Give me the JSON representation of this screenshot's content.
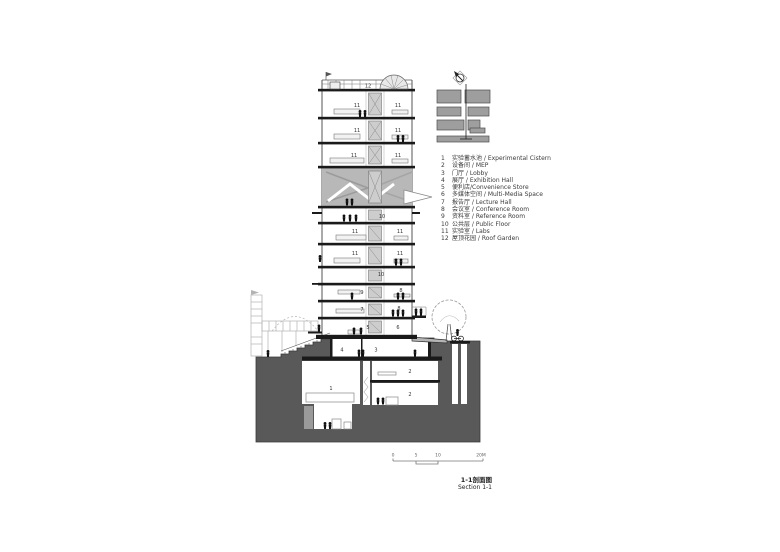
{
  "legend": {
    "items": [
      {
        "num": "1",
        "label": "实验蓄水池 / Experimental Cistern"
      },
      {
        "num": "2",
        "label": "设备间 / MEP"
      },
      {
        "num": "3",
        "label": "门厅 / Lobby"
      },
      {
        "num": "4",
        "label": "展厅 / Exhibition Hall"
      },
      {
        "num": "5",
        "label": "便利店/Convenience Store"
      },
      {
        "num": "6",
        "label": "多媒体空间 / Multi-Media Space"
      },
      {
        "num": "7",
        "label": "报告厅 / Lecture Hall"
      },
      {
        "num": "8",
        "label": "会议室 / Conference Room"
      },
      {
        "num": "9",
        "label": "资料室 / Reference Room"
      },
      {
        "num": "10",
        "label": "公共层 / Public Floor"
      },
      {
        "num": "11",
        "label": "实验室 / Labs"
      },
      {
        "num": "12",
        "label": "屋顶花园 / Roof Garden"
      }
    ]
  },
  "section": {
    "floors": {
      "cistern": "1",
      "mep": "2",
      "lobby": "3",
      "exhibition": "4",
      "store": "5",
      "multimedia": "6",
      "lecture": "7",
      "conference": "8",
      "reference": "9",
      "public": "10",
      "labs": "11",
      "roof_garden": "12"
    }
  },
  "title": {
    "zh": "1-1剖面图",
    "en": "Section 1-1"
  },
  "scale_bar": {
    "ticks": [
      "0",
      "5",
      "10",
      "20M"
    ]
  },
  "colors": {
    "ground_fill": "#595959",
    "cut_fill": "#1a1a1a",
    "multimedia_gray": "#b8b8b8",
    "keyplan_block": "#9e9e9e",
    "line": "#555555"
  }
}
